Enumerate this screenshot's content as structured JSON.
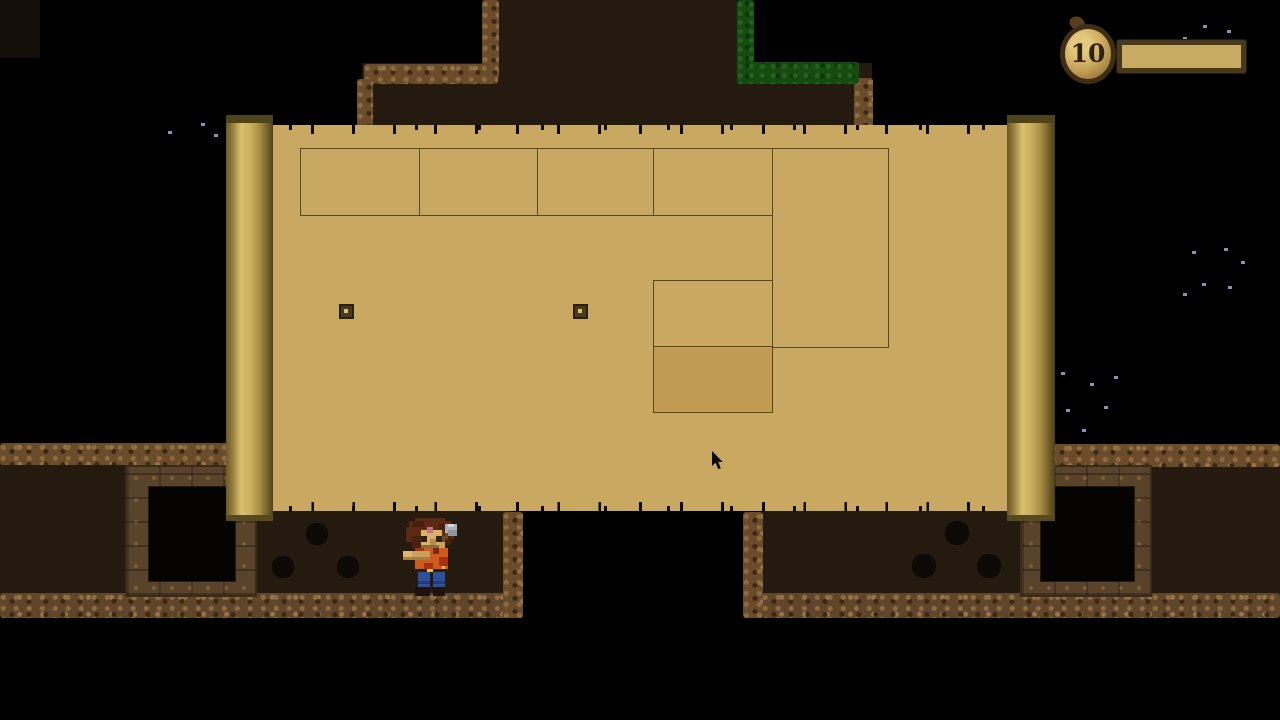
{
  "hud": {
    "coin_count": "10",
    "coin_icon": "coin-bag-icon",
    "bar_fill_percent": 100
  },
  "map_panel": {
    "rooms": [
      {
        "x": 300,
        "y": 148,
        "w": 120,
        "h": 68,
        "current": false
      },
      {
        "x": 419,
        "y": 148,
        "w": 119,
        "h": 68,
        "current": false
      },
      {
        "x": 537,
        "y": 148,
        "w": 117,
        "h": 68,
        "current": false
      },
      {
        "x": 653,
        "y": 148,
        "w": 120,
        "h": 68,
        "current": false
      },
      {
        "x": 772,
        "y": 148,
        "w": 117,
        "h": 200,
        "current": false
      },
      {
        "x": 653,
        "y": 280,
        "w": 120,
        "h": 67,
        "current": false
      },
      {
        "x": 653,
        "y": 346,
        "w": 120,
        "h": 67,
        "current": true
      }
    ],
    "pins": [
      {
        "x": 339,
        "y": 304
      },
      {
        "x": 573,
        "y": 304
      }
    ]
  },
  "cave": {
    "holes": [
      {
        "x": 306,
        "y": 523,
        "s": 22
      },
      {
        "x": 272,
        "y": 556,
        "s": 22
      },
      {
        "x": 337,
        "y": 556,
        "s": 22
      },
      {
        "x": 945,
        "y": 521,
        "s": 24
      },
      {
        "x": 912,
        "y": 554,
        "s": 24
      },
      {
        "x": 977,
        "y": 554,
        "s": 24
      }
    ]
  },
  "particles": [
    {
      "x": 168,
      "y": 131
    },
    {
      "x": 201,
      "y": 123
    },
    {
      "x": 214,
      "y": 134
    },
    {
      "x": 1183,
      "y": 37
    },
    {
      "x": 1203,
      "y": 25
    },
    {
      "x": 1227,
      "y": 30
    },
    {
      "x": 1192,
      "y": 251
    },
    {
      "x": 1224,
      "y": 248
    },
    {
      "x": 1241,
      "y": 261
    },
    {
      "x": 1202,
      "y": 283
    },
    {
      "x": 1228,
      "y": 286
    },
    {
      "x": 1183,
      "y": 293
    },
    {
      "x": 1061,
      "y": 372
    },
    {
      "x": 1090,
      "y": 383
    },
    {
      "x": 1114,
      "y": 376
    },
    {
      "x": 1066,
      "y": 409
    },
    {
      "x": 1104,
      "y": 406
    },
    {
      "x": 1082,
      "y": 429
    }
  ],
  "cursor": {
    "x": 711,
    "y": 451
  },
  "colors": {
    "parchment": "#c9a861",
    "map-line": "#574726",
    "map-room-current": "#c19b52",
    "cave-interior": "#241a0f",
    "rock-base": "#6a4c2a",
    "moss-base": "#164a10",
    "bar-fill": "#c7ab62",
    "particle": "#9a87c0"
  }
}
